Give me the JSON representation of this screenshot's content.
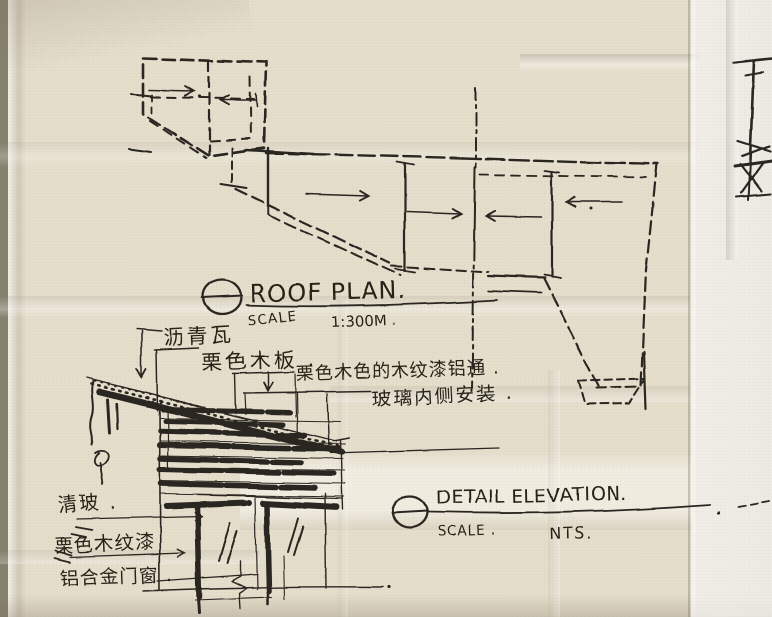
{
  "roof_plan": {
    "marker_icon": "section-marker-circle-icon",
    "title": "ROOF PLAN.",
    "scale_label": "SCALE",
    "scale_value": "1:300M .",
    "arrows": "slope-direction-arrows-toward-ridge"
  },
  "detail_elevation": {
    "marker_icon": "section-marker-circle-icon",
    "title": "DETAIL ELEVATION.",
    "scale_label": "SCALE .",
    "scale_value": "NTS.",
    "labels": {
      "asphalt_shingle": "沥青瓦",
      "chestnut_wood_board": "栗色木板 .",
      "wood_grain_aluminum_tube": "栗色木色的木纹漆铝通 .",
      "glass_inner_side_install": "玻璃内侧安装 .",
      "clear_glass": "清玻 .",
      "chestnut_wood_grain_paint": "栗色木纹漆",
      "aluminum_alloy_doors_windows": "铝合金门窗 ."
    }
  },
  "colors": {
    "ink": "#2b2620",
    "paper": "#e5decb",
    "paper_bright": "#f2f0e8",
    "paper_shadow": "#b9b09b",
    "backdrop": "#87816f"
  }
}
